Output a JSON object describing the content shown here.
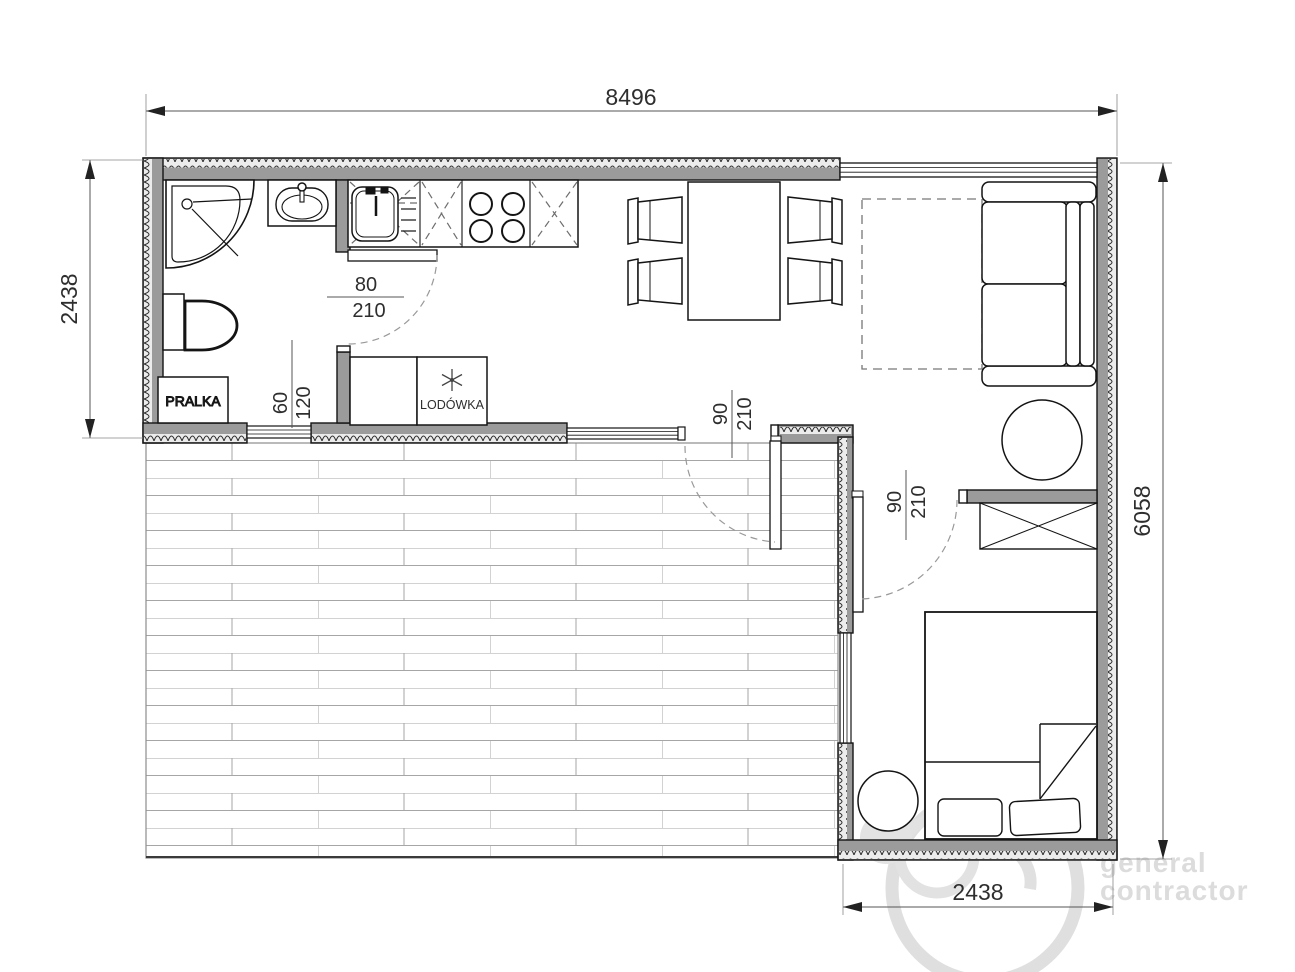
{
  "drawing": {
    "type": "architectural-floor-plan",
    "units_note": "mm overall / cm openings"
  },
  "dimensions": {
    "overall_width": "8496",
    "left_section_height": "2438",
    "overall_right_height": "6058",
    "bedroom_width": "2438"
  },
  "openings": {
    "bathroom_door": {
      "width": "80",
      "height": "210"
    },
    "bathroom_window": {
      "width": "60",
      "height": "120"
    },
    "terrace_door": {
      "width": "90",
      "height": "210"
    },
    "bedroom_door": {
      "width": "90",
      "height": "210"
    }
  },
  "labels": {
    "washing_machine": "PRALKA",
    "fridge": "LODÓWKA"
  },
  "icons": {
    "fridge_symbol": "snowflake-asterisk-icon"
  },
  "watermark": {
    "line1": "general",
    "line2": "contractor"
  },
  "colors": {
    "background": "#ffffff",
    "wall_fill": "#9b9b9b",
    "line": "#141414",
    "dimension_text": "#2e2e2e",
    "dashed_aux": "#777777",
    "deck_line": "#a6a6a6",
    "watermark": "#dcdcdc"
  }
}
